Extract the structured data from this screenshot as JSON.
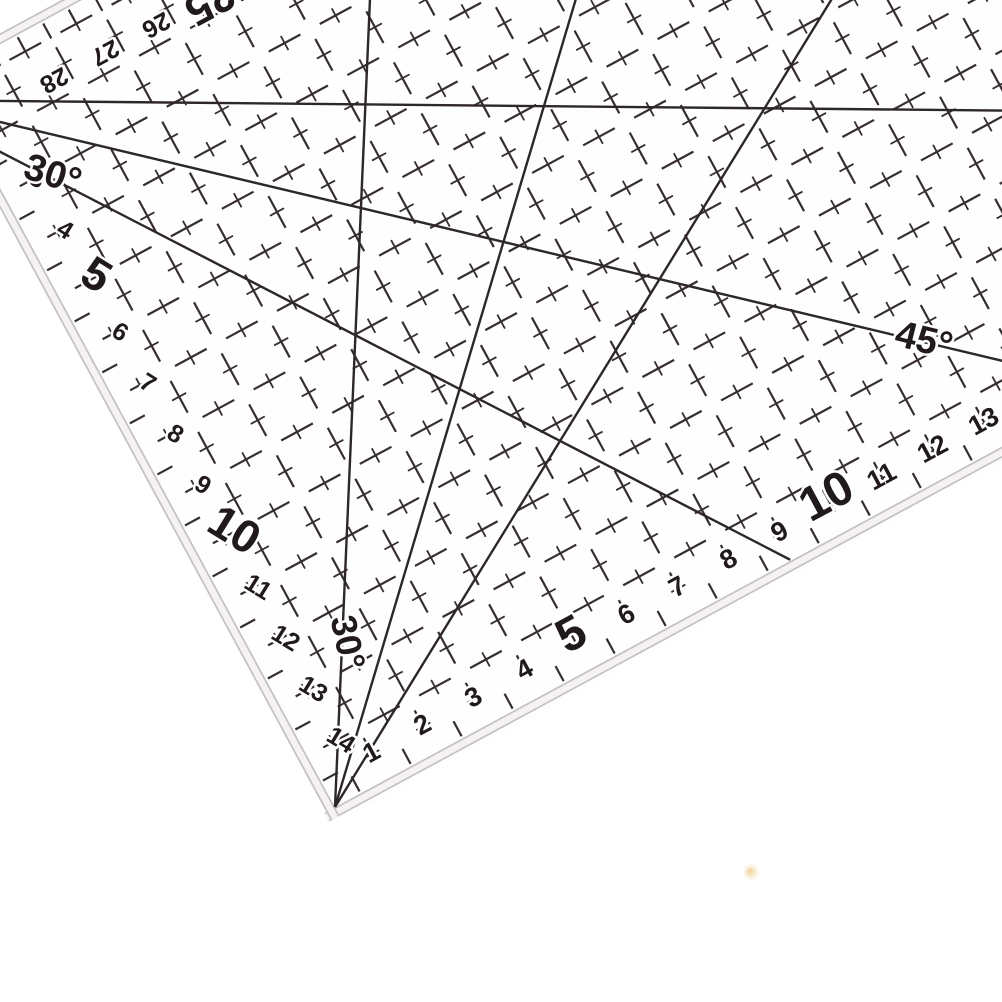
{
  "meta": {
    "description": "Close-up photo of a transparent acrylic quilting patchwork ruler with dark grid lines, angle guide lines and centimetre scales, lying on a white background"
  },
  "ruler": {
    "bottom_scale": {
      "numbers": [
        1,
        2,
        3,
        4,
        5,
        6,
        7,
        8,
        9,
        10,
        11,
        12,
        13
      ],
      "emphasized": [
        5,
        10
      ]
    },
    "left_scale": {
      "numbers": [
        3,
        4,
        5,
        6,
        7,
        8,
        9,
        10,
        11,
        12,
        13,
        14
      ],
      "emphasized": [
        5,
        10
      ]
    },
    "top_scale": {
      "numbers": [
        25,
        26,
        27,
        28
      ],
      "emphasized": [
        25
      ]
    },
    "angle_labels": [
      {
        "text": "30°",
        "location": "upper-left"
      },
      {
        "text": "45°",
        "location": "mid-right"
      },
      {
        "text": "30°",
        "location": "near-corner-rotated"
      }
    ],
    "colors": {
      "ink": "#362e2e",
      "line_ink": "#2e2727",
      "number_ink": "#201a1a",
      "bevel_fill": "#f4f2f2",
      "bevel_line": "#c6c1c1",
      "background": "#ffffff",
      "speck": "#f3d9a8"
    }
  }
}
